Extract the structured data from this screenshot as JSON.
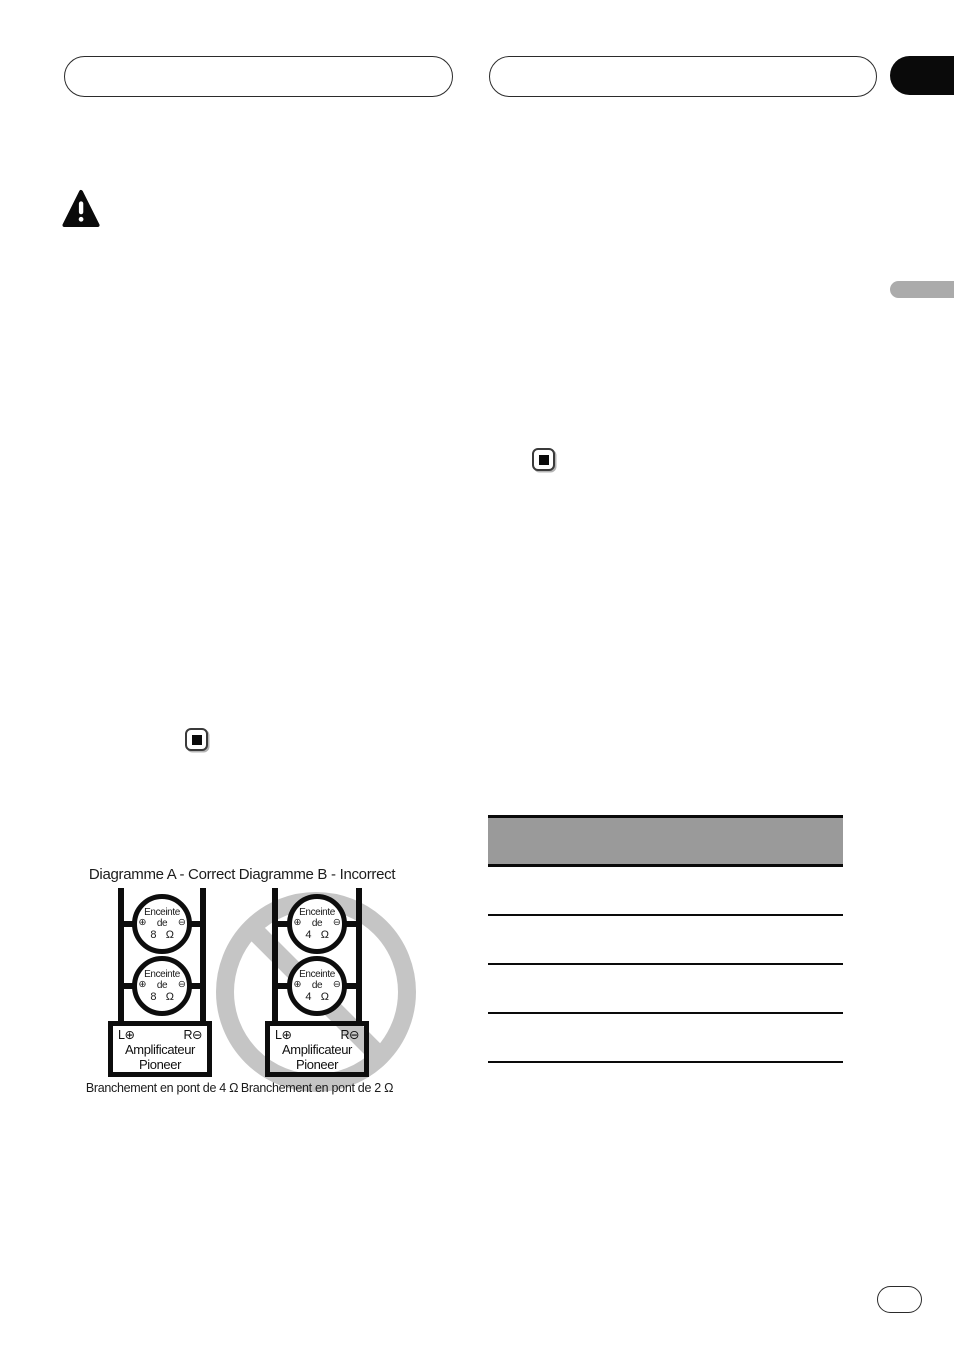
{
  "header": {
    "left_tab": "",
    "right_tab": "",
    "corner_tab": ""
  },
  "side_badge": "",
  "page_pill": "",
  "diagram_a": {
    "title": "Diagramme A - Correct",
    "speakers": [
      {
        "name": "Enceinte",
        "plus": "⊕",
        "de": "de",
        "minus": "⊖",
        "impedance": "8 Ω"
      },
      {
        "name": "Enceinte",
        "plus": "⊕",
        "de": "de",
        "minus": "⊖",
        "impedance": "8 Ω"
      }
    ],
    "amplifier": {
      "left_terminal": "L⊕",
      "right_terminal": "R⊖",
      "line1": "Amplificateur",
      "line2": "Pioneer"
    },
    "caption": "Branchement en pont de 4 Ω"
  },
  "diagram_b": {
    "title": "Diagramme B - Incorrect",
    "speakers": [
      {
        "name": "Enceinte",
        "plus": "⊕",
        "de": "de",
        "minus": "⊖",
        "impedance": "4 Ω"
      },
      {
        "name": "Enceinte",
        "plus": "⊕",
        "de": "de",
        "minus": "⊖",
        "impedance": "4 Ω"
      }
    ],
    "amplifier": {
      "left_terminal": "L⊕",
      "right_terminal": "R⊖",
      "line1": "Amplificateur",
      "line2": "Pioneer"
    },
    "caption": "Branchement en pont de 2 Ω"
  },
  "table": {
    "header": "",
    "rows": [
      "",
      "",
      "",
      ""
    ]
  },
  "colors": {
    "table_header_gray": "#9a9a9a",
    "prohibition_gray": "#c5c5c5",
    "side_badge_gray": "#ababab",
    "corner_tab_black": "#0a0a0a",
    "ink": "#111111"
  }
}
